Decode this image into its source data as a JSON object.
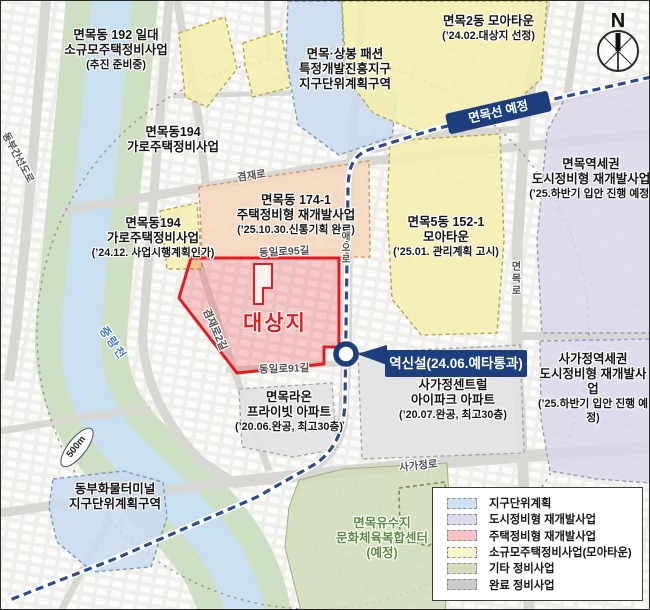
{
  "compass": {
    "label": "N"
  },
  "scale": {
    "label": "500m"
  },
  "railway": {
    "line_badge": "면목선 예정",
    "station_callout": "역신설(24.06.예타통과)"
  },
  "zones": {
    "z192": {
      "lines": [
        "면목동 192 일대",
        "소규모주택정비사업",
        "(추진 준비중)"
      ]
    },
    "fashion": {
      "lines": [
        "면목·상봉 패션",
        "특정개발진흥지구",
        "지구단위계획구역"
      ]
    },
    "moa2": {
      "lines": [
        "면목2동 모아타운",
        "(’24.02.대상지 선정)"
      ]
    },
    "n194_top": {
      "lines": [
        "면목동194",
        "가로주택정비사업"
      ]
    },
    "a174": {
      "lines": [
        "면목동 174-1",
        "주택정비형 재개발사업",
        "(’25.10.30.신통기획 완료)"
      ]
    },
    "moa5": {
      "lines": [
        "면목5동 152-1",
        "모아타운",
        "(’25.01. 관리계획 고시)"
      ]
    },
    "mm_station": {
      "lines": [
        "면목역세권",
        "도시정비형 재개발사업",
        "(’25.하반기 입안 진행 예정)"
      ]
    },
    "n194_left": {
      "lines": [
        "면목동194",
        "가로주택정비사업",
        "(’24.12. 사업시행계획인가)"
      ]
    },
    "target": {
      "label": "대상지"
    },
    "sgj_station": {
      "lines": [
        "사가정역세권",
        "도시정비형 재개발사업",
        "(’25.하반기 입안 진행 예정)"
      ]
    },
    "raon": {
      "lines": [
        "면목라온",
        "프라이빗 아파트",
        "(’20.06.완공, 최고30층)"
      ]
    },
    "ipark": {
      "lines": [
        "사가정센트럴",
        "아이파크 아파트",
        "(’20.07.완공, 최고30층)"
      ]
    },
    "terminal": {
      "lines": [
        "동부화물터미널",
        "지구단위계획구역"
      ]
    },
    "yusuji": {
      "lines": [
        "면목유수지",
        "문화체육복합센터",
        "(예정)"
      ]
    }
  },
  "roads": {
    "dongbu": "동부간선도로",
    "jungnangcheon": "중랑천",
    "gyeomjae": "겸재로",
    "dongil95": "동일로95길",
    "dongil91": "동일로91길",
    "gyeomjae2": "겸재로2길",
    "aeo": "애오로",
    "myeonmok": "면목로",
    "sagajeong": "사가정로"
  },
  "legend": {
    "items": [
      {
        "label": "지구단위계획",
        "color": "#cfe2f4"
      },
      {
        "label": "도시정비형 재개발사업",
        "color": "#ded9ec"
      },
      {
        "label": "주택정비형 재개발사업",
        "color": "#f8c2c7"
      },
      {
        "label": "소규모주택정비사업(모아타운)",
        "color": "#f8f4cd"
      },
      {
        "label": "기타 정비사업",
        "color": "#d6ddbb"
      },
      {
        "label": "완료 정비사업",
        "color": "#cbcbcb"
      }
    ]
  },
  "colors": {
    "navy": "#1d3e7c",
    "target_red": "#e8191d",
    "river_blue": "#c8e0f0",
    "bank_green": "#cfdfc3",
    "park_green": "#d0dbb8",
    "road_gray": "#d8d7d4"
  }
}
